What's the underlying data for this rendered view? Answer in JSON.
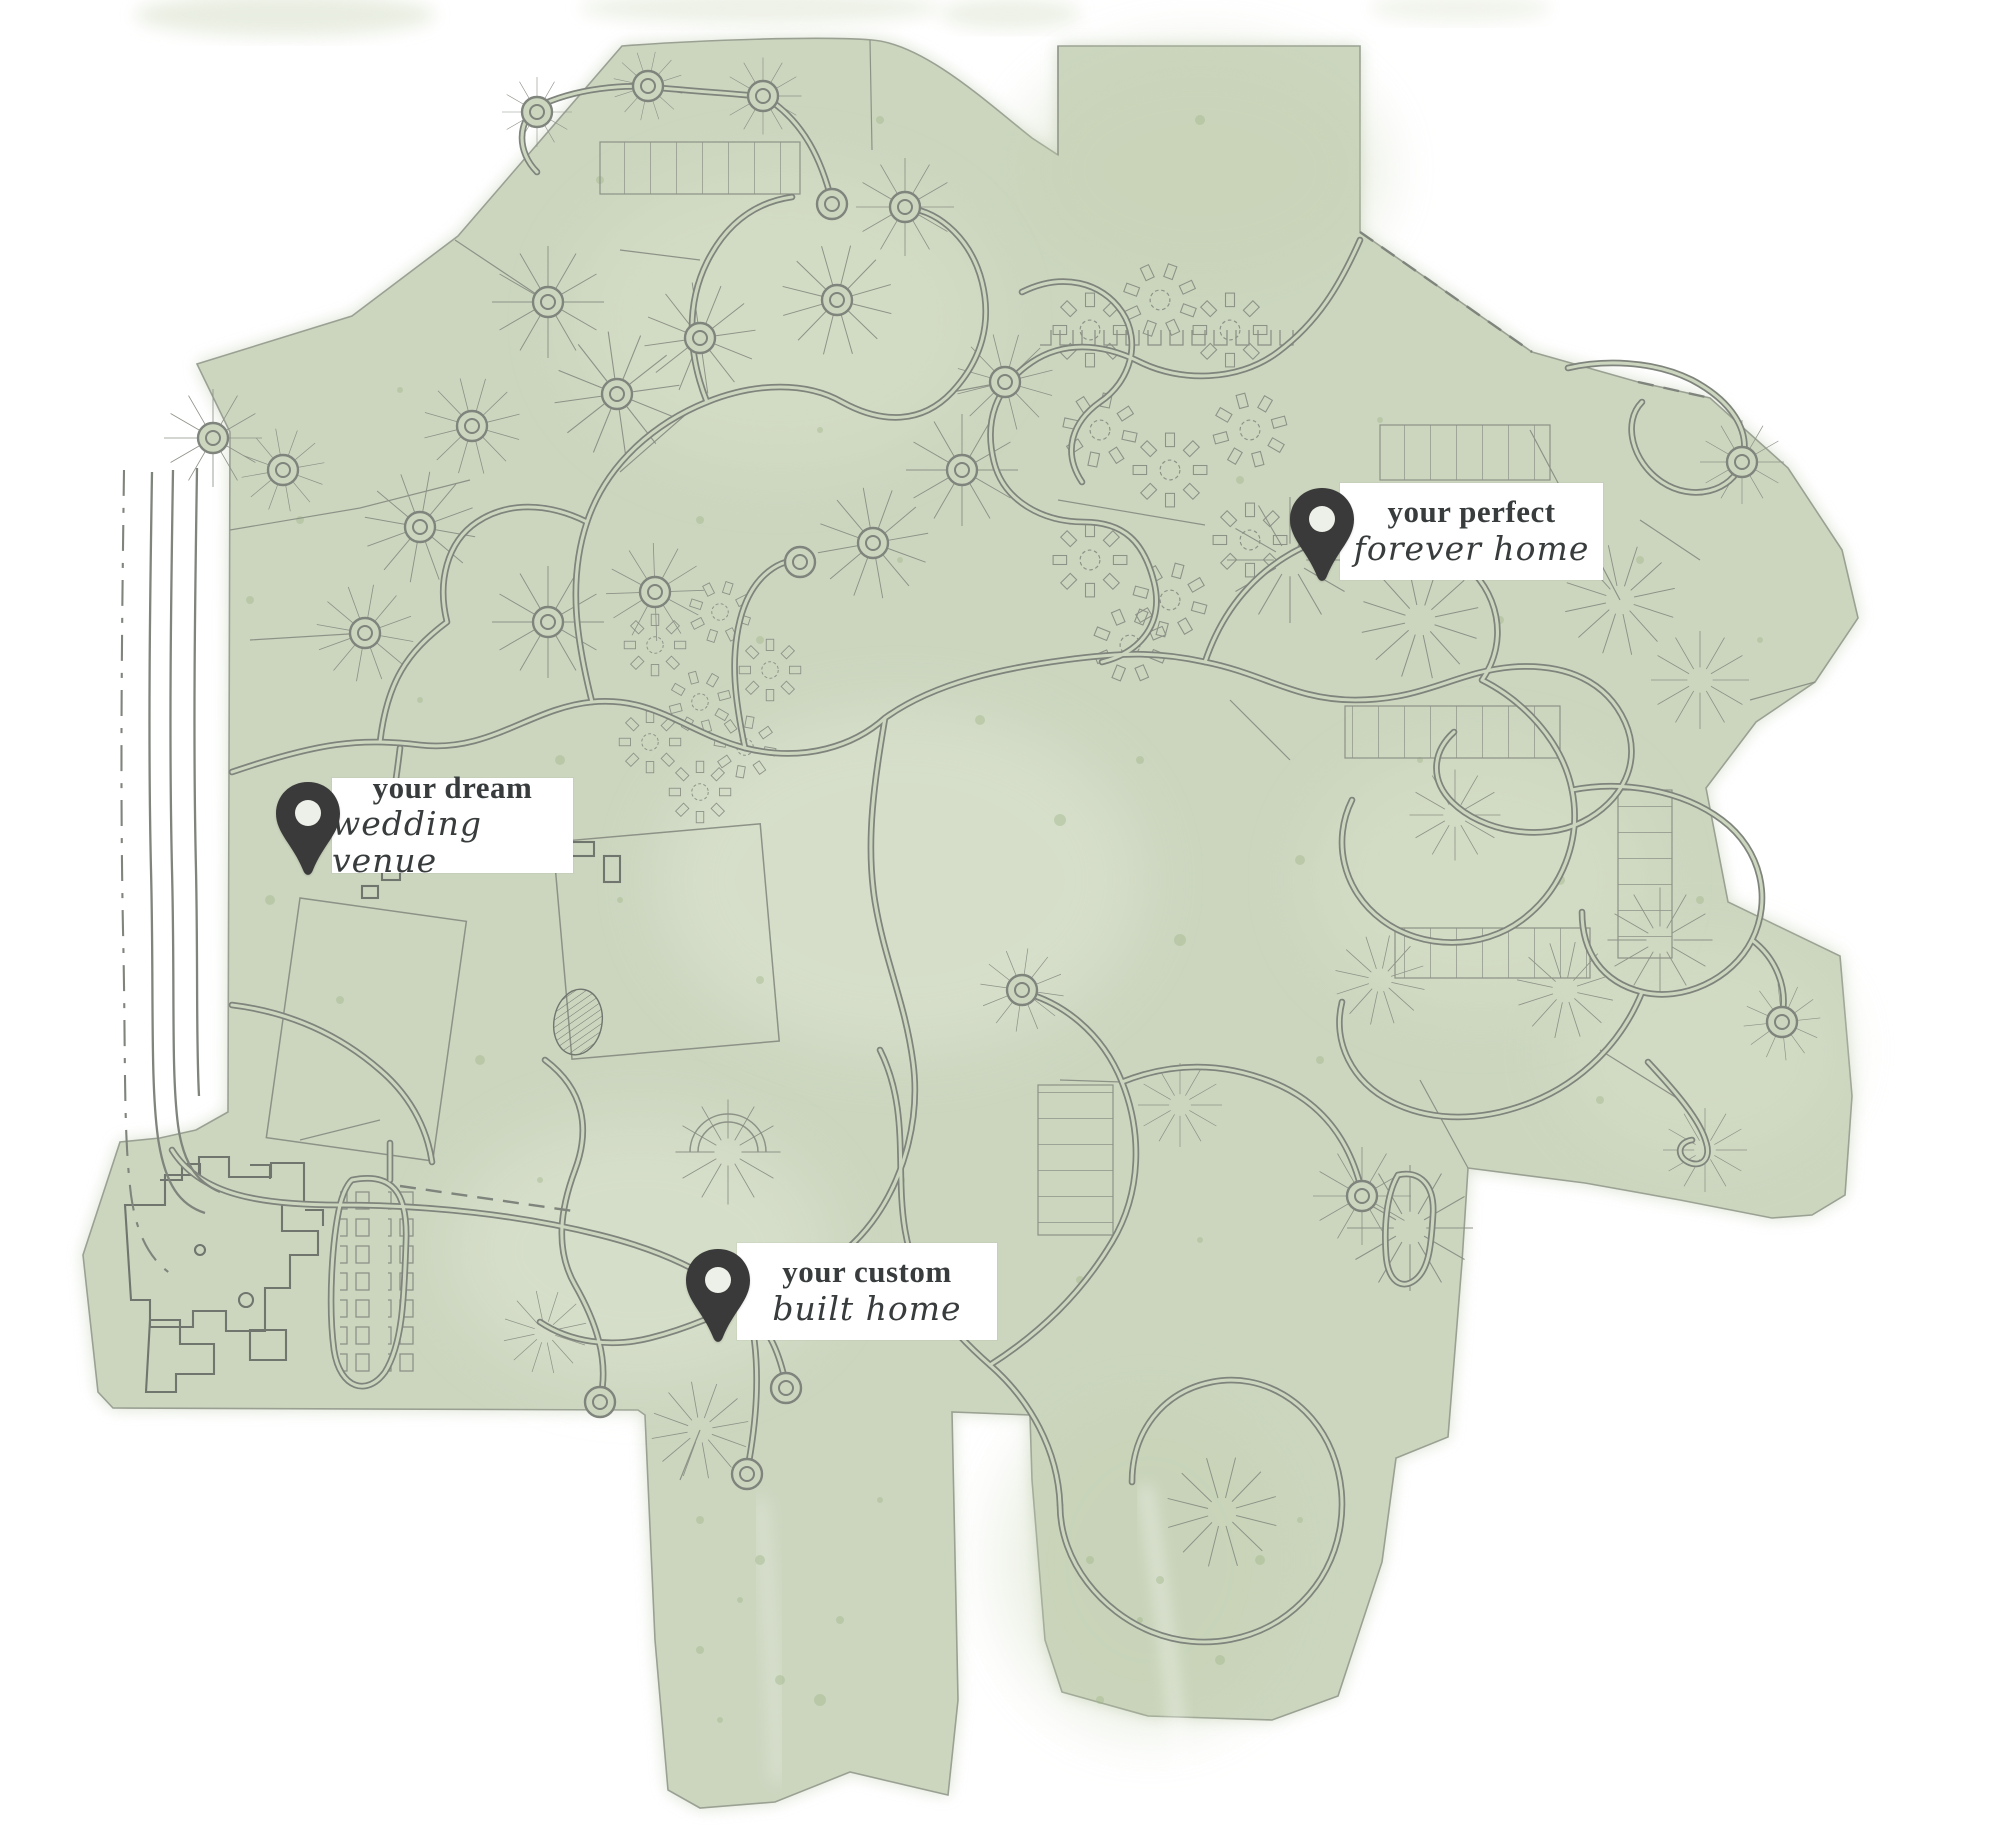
{
  "colors": {
    "land": "#ccd6bf",
    "land-light": "#dde4d2",
    "speckle": "#a3b98c",
    "road": "#7f847c",
    "parcel": "#8d9287",
    "pin": "#3a3a3a",
    "label-bg": "#ffffff",
    "label-text": "#383c3d"
  },
  "markers": [
    {
      "id": "forever-home",
      "icon": "map-pin",
      "line1": "your perfect",
      "line2": "forever home"
    },
    {
      "id": "wedding-venue",
      "icon": "map-pin",
      "line1": "your dream",
      "line2": "wedding venue"
    },
    {
      "id": "custom-built-home",
      "icon": "map-pin",
      "line1": "your custom",
      "line2": "built home"
    }
  ]
}
